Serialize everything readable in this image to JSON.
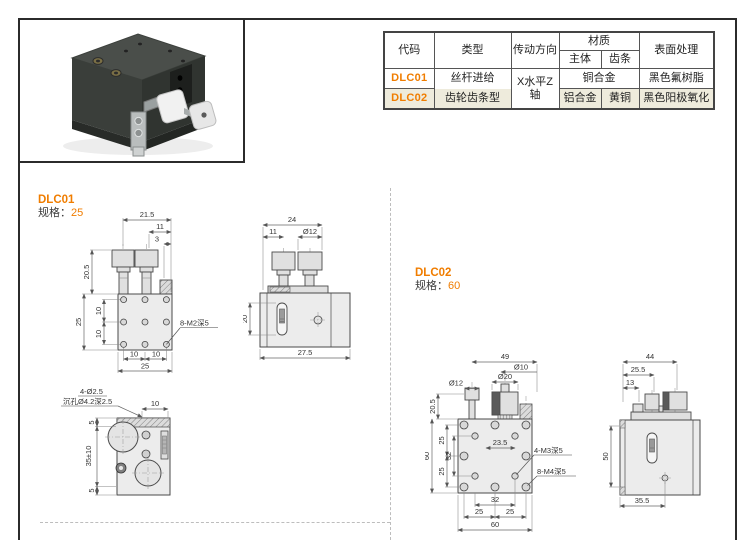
{
  "accent_color": "#f07d00",
  "row_highlight_color": "#eeebdc",
  "photo": {
    "description": "black XZ-axis dovetail translation stage with two white adjustment knobs"
  },
  "table": {
    "headers": {
      "code": "代码",
      "type": "类型",
      "direction": "传动方向",
      "material": "材质",
      "material_body": "主体",
      "material_rack": "齿条",
      "surface": "表面处理"
    },
    "direction_merged": "X水平Z轴",
    "rows": [
      {
        "code": "DLC01",
        "type": "丝杆进给",
        "material_merged": "铜合金",
        "surface": "黑色氟树脂"
      },
      {
        "code": "DLC02",
        "type": "齿轮齿条型",
        "material_body": "铝合金",
        "material_rack": "黄铜",
        "surface": "黑色阳极氧化"
      }
    ]
  },
  "sections": {
    "dlc01": {
      "title": "DLC01",
      "spec_label": "规格：",
      "spec_value": "25"
    },
    "dlc02": {
      "title": "DLC02",
      "spec_label": "规格：",
      "spec_value": "60"
    }
  },
  "drawings": {
    "dlc01_front": {
      "dim_top_1": "21.5",
      "dim_top_2": "11",
      "dim_top_3": "3",
      "dim_left_knob": "20.5",
      "dim_left_body": "25",
      "dim_left_hole_1": "10",
      "dim_left_hole_2": "10",
      "dim_bot_1": "10",
      "dim_bot_2": "10",
      "dim_bot_3": "25",
      "thread_label": "8-M2深5"
    },
    "dlc01_side": {
      "dim_top_1": "24",
      "dim_top_2": "11",
      "dim_top_3": "Ø12",
      "dim_left": "20",
      "dim_bot": "27.5"
    },
    "dlc01_bottom": {
      "hole_label": "4-Ø2.5",
      "cbore_label": "沉孔Ø4.2深2.5",
      "dim_top": "10",
      "dim_left_1": "5",
      "dim_left_2": "35±10",
      "dim_left_3": "5"
    },
    "dlc02_front": {
      "dim_top_1": "49",
      "dim_top_2": "Ø10",
      "dim_top_3": "Ø20",
      "dim_top_4": "Ø12",
      "dim_left_knob": "20.5",
      "dim_left_body": "60",
      "dim_left_1": "25",
      "dim_left_2": "32",
      "dim_left_3": "25",
      "dim_mid": "23.5",
      "label_m3": "4-M3深5",
      "label_m4": "8-M4深5",
      "dim_bot_1": "32",
      "dim_bot_2": "25",
      "dim_bot_3": "25",
      "dim_bot_4": "60"
    },
    "dlc02_side": {
      "dim_top_1": "44",
      "dim_top_2": "25.5",
      "dim_top_3": "13",
      "dim_left": "50",
      "dim_bot": "35.5"
    }
  }
}
